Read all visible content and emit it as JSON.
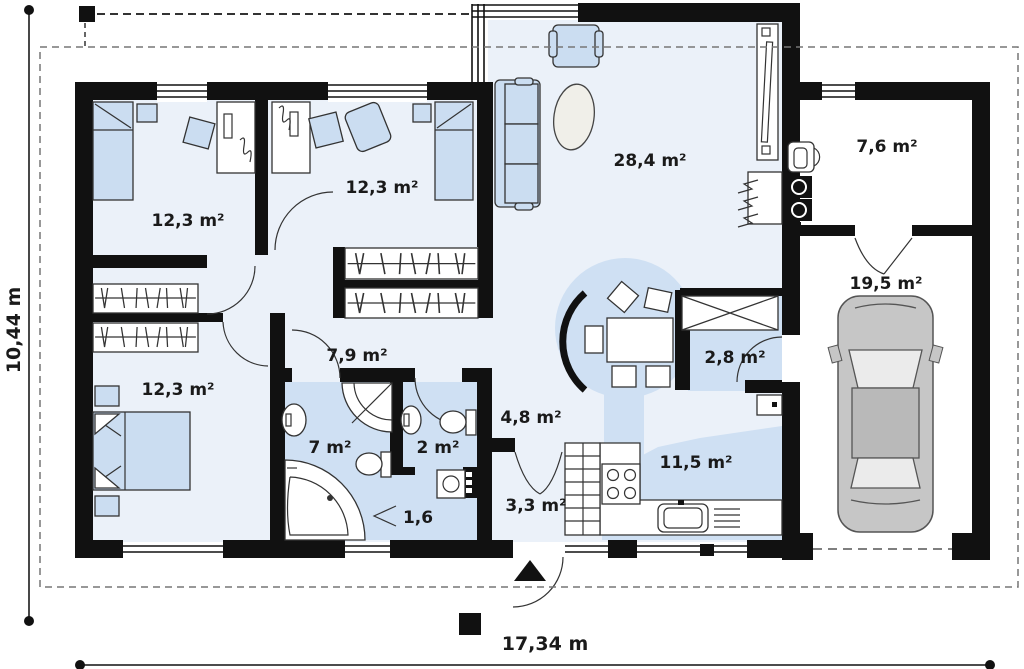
{
  "title": "Single family house first floor plan",
  "rooms": {
    "bedroom1": "12,3 m²",
    "bedroom2": "12,3 m²",
    "bedroom3": "12,3 m²",
    "living": "28,4 m²",
    "hallway": "7,9 m²",
    "bathroom": "7 m²",
    "wc": "2 m²",
    "closet": "1,6",
    "hall": "4,8 m²",
    "entry": "3,3 m²",
    "kitchen": "11,5 m²",
    "pantry": "2,8 m²",
    "utility": "7,6 m²",
    "garage": "19,5 m²"
  },
  "dimensions": {
    "width": "17,34 m",
    "height": "10,44 m"
  },
  "colors": {
    "wall": "#111111",
    "floor_light": "#ebf1f9",
    "floor_blue": "#cfe0f3",
    "furniture": "#cbddf1",
    "car_body": "#c6c6c6"
  }
}
